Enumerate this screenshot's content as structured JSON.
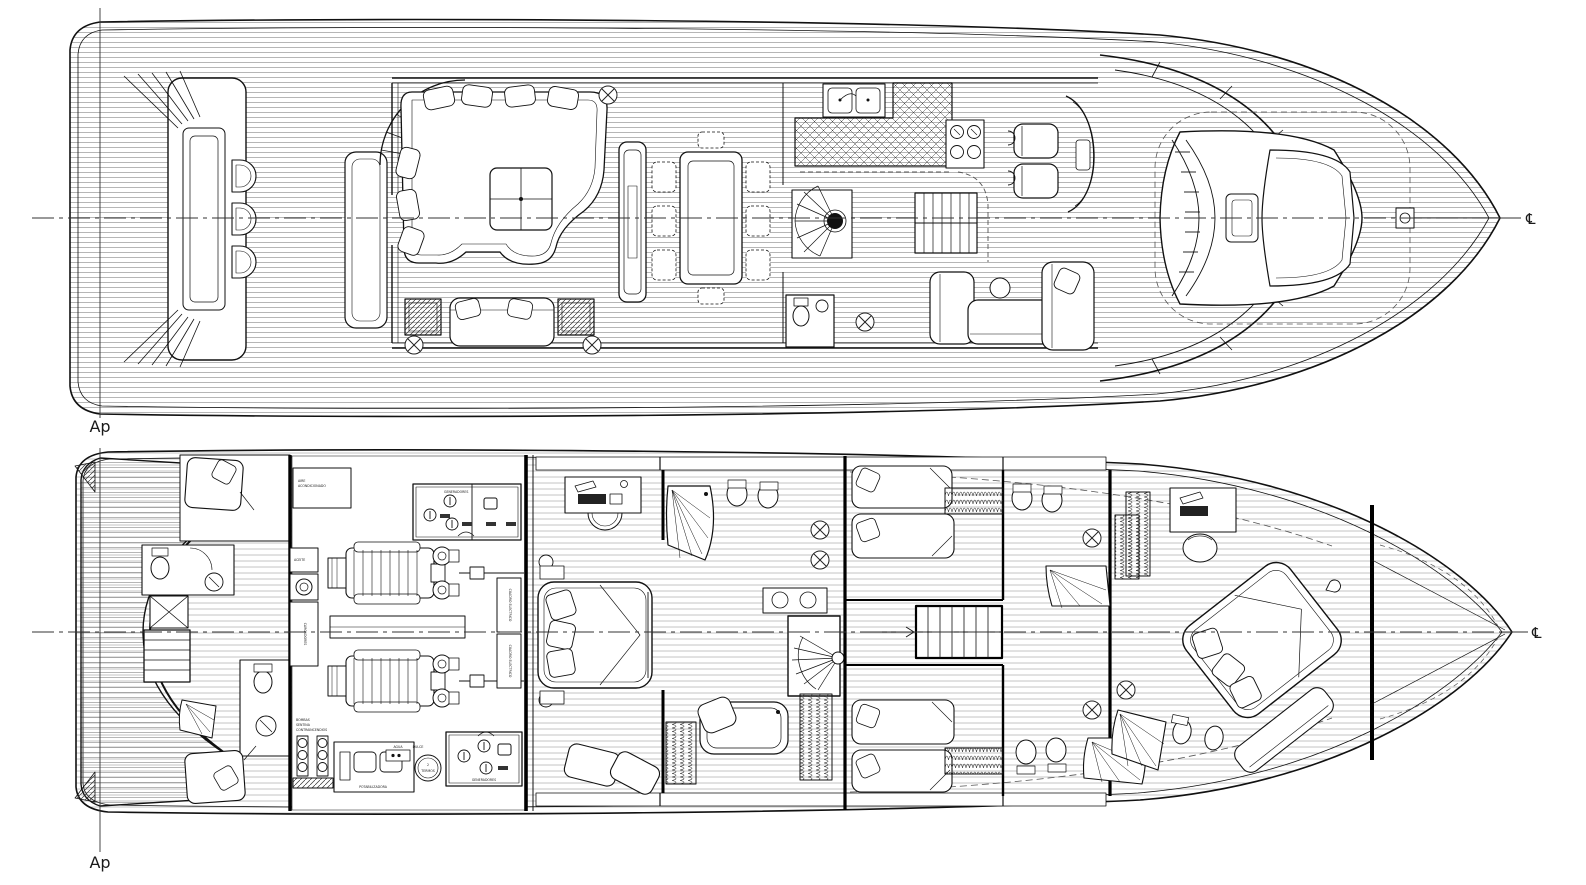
{
  "labels": {
    "ap_main": "Ap",
    "ap_lower": "Ap",
    "centerline_main": "℄",
    "centerline_lower": "℄"
  },
  "engine_room": {
    "aire_1": "AIRE",
    "aire_2": "ACONDICIONADO",
    "generadores_fwd": "GENERADORES",
    "generadores_aft": "GENERADORES",
    "cuadro_1": "CUADRO ELECTRICO",
    "cuadro_2": "CUADRO ELECTRICO",
    "aceite": "ACEITE",
    "cargadores": "CARGADORES",
    "bombas_1": "BOMBAS",
    "bombas_2": "SENTINA",
    "bombas_3": "CONTRAINCENDIOS",
    "potabilizadora": "POTABILIZADORA",
    "agua_1": "AGUA",
    "agua_2": "DULCE",
    "termos_1": "2",
    "termos_2": "TERMOS"
  },
  "colors": {
    "ink": "#1a1a1a",
    "paper": "#ffffff"
  }
}
